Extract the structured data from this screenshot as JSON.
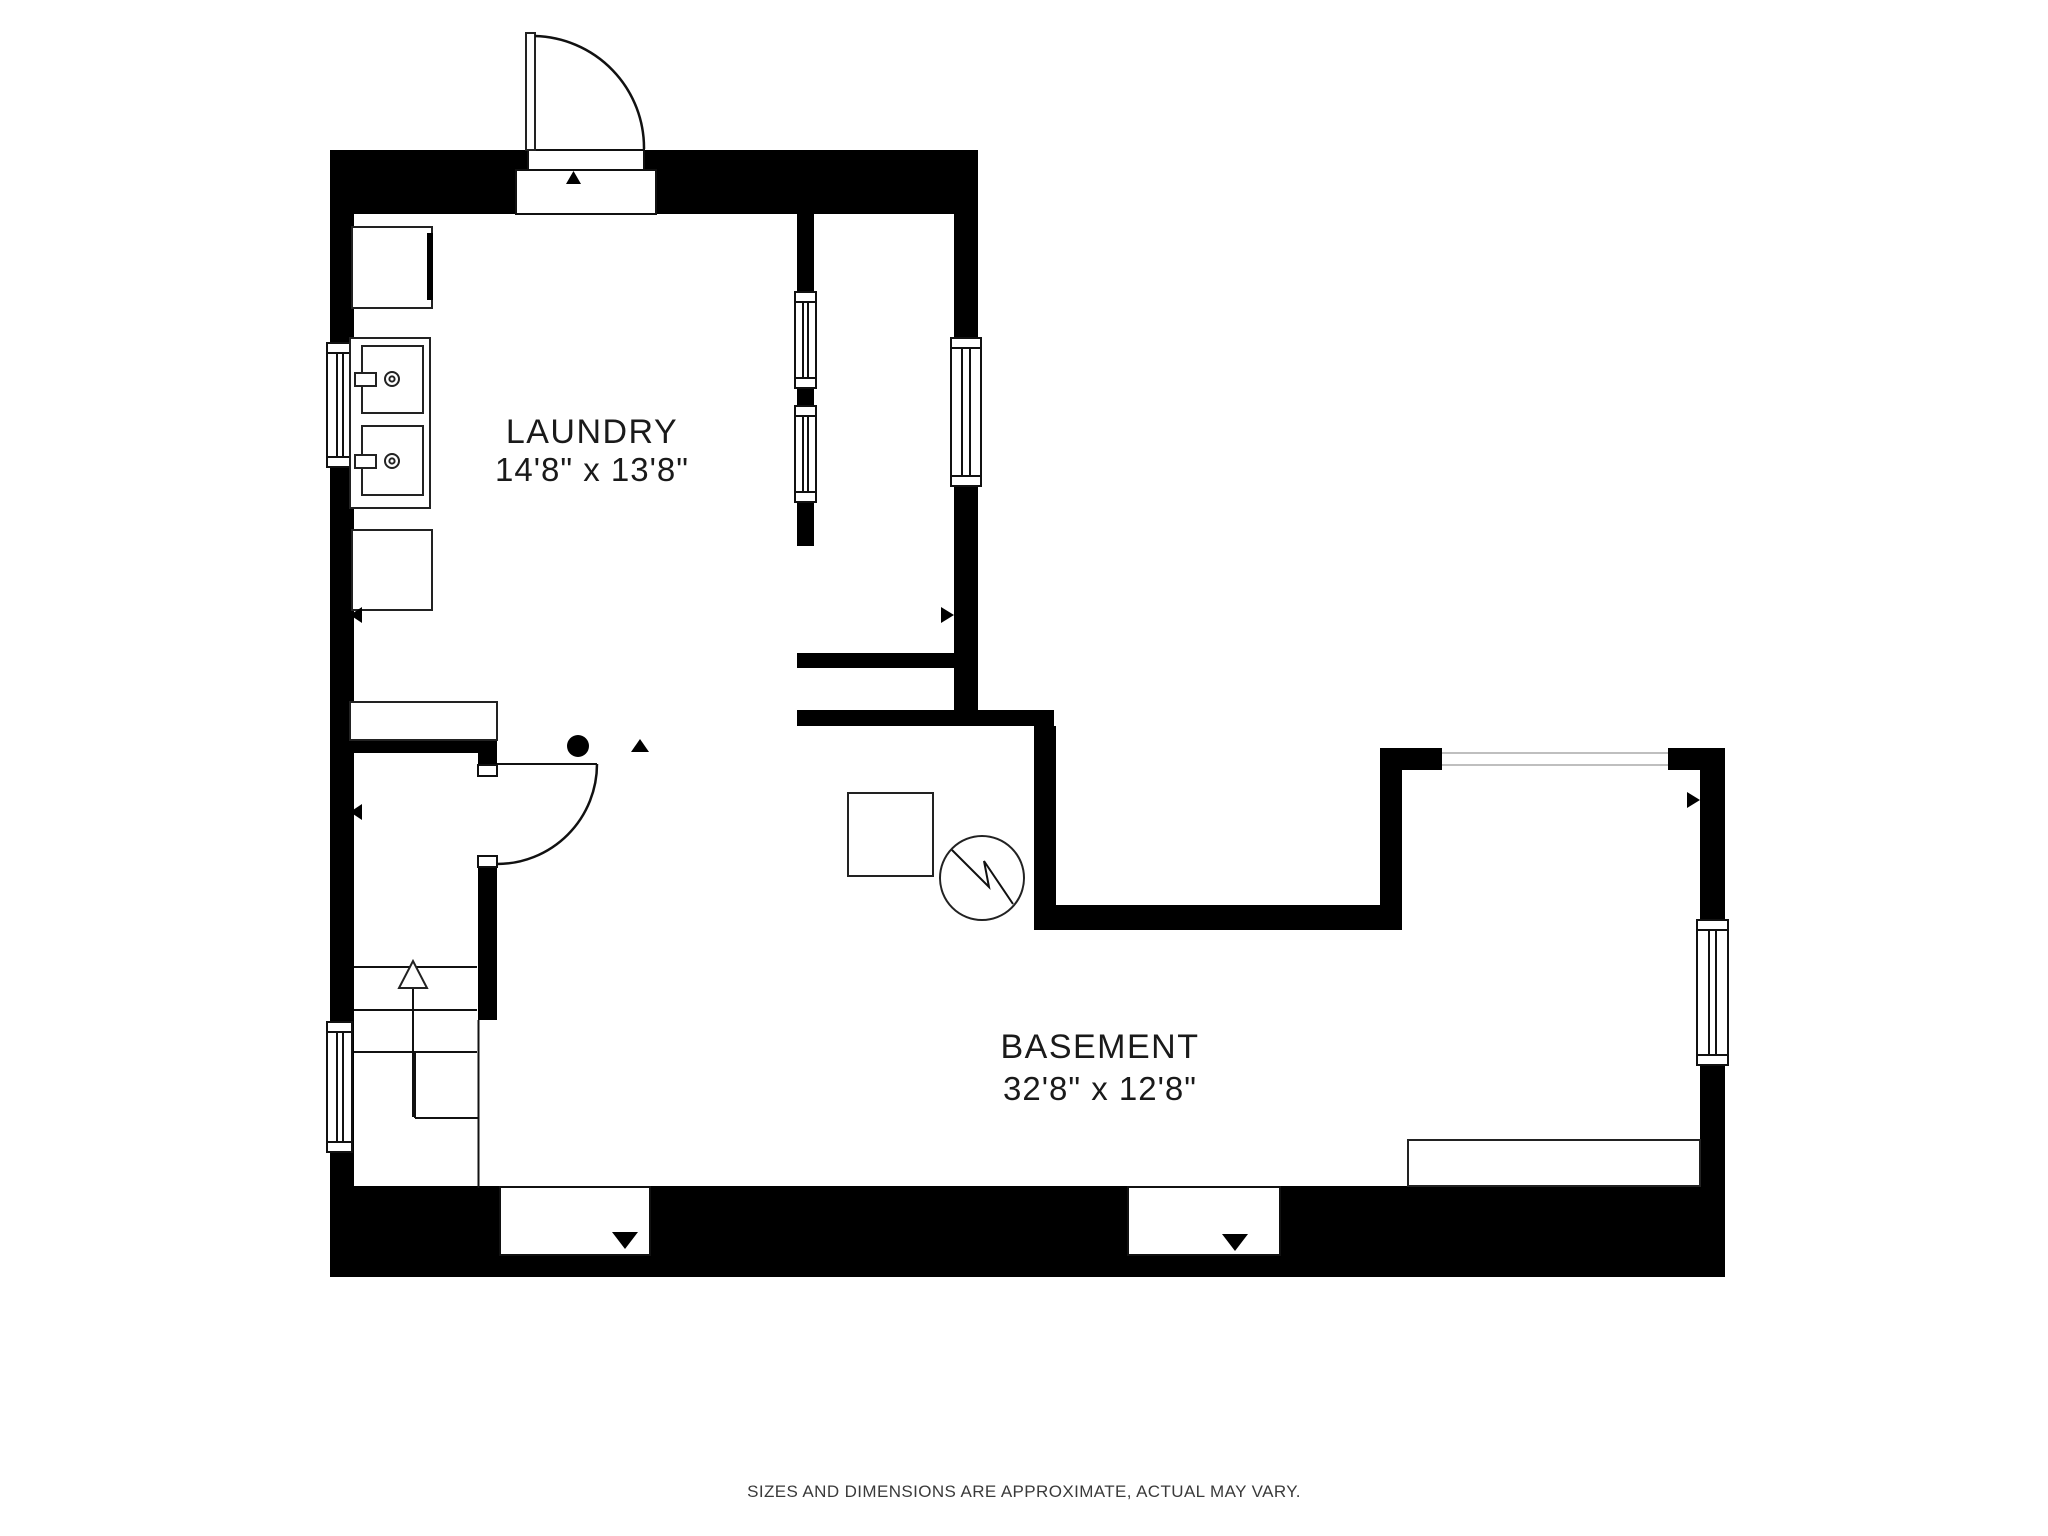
{
  "page": {
    "background_color": "#ffffff",
    "footer_disclaimer": "SIZES AND DIMENSIONS ARE APPROXIMATE, ACTUAL MAY VARY."
  },
  "floorplan": {
    "type": "basement-floor-plan",
    "wall_color": "#000000",
    "line_color": "#111111",
    "rooms": [
      {
        "id": "laundry",
        "label": "LAUNDRY",
        "dimensions": "14'8\" x 13'8\""
      },
      {
        "id": "basement",
        "label": "BASEMENT",
        "dimensions": "32'8\" x 12'8\""
      }
    ],
    "fixtures": [
      {
        "name": "washer-box-icon"
      },
      {
        "name": "double-laundry-sink-icon"
      },
      {
        "name": "dryer-box-icon"
      },
      {
        "name": "counter-icon"
      },
      {
        "name": "stairs-up-icon"
      },
      {
        "name": "water-heater-square-icon"
      },
      {
        "name": "furnace-circle-icon"
      },
      {
        "name": "shelf-icon"
      },
      {
        "name": "floor-drain-dot-icon"
      }
    ],
    "openings": [
      {
        "name": "entry-door-top"
      },
      {
        "name": "stair-closet-door"
      },
      {
        "name": "bottom-left-doorway"
      },
      {
        "name": "bottom-right-doorway"
      },
      {
        "name": "window-left-upper"
      },
      {
        "name": "window-left-lower"
      },
      {
        "name": "interior-glass-panel-1"
      },
      {
        "name": "interior-glass-panel-2"
      },
      {
        "name": "window-laundry-right"
      },
      {
        "name": "window-top-right"
      },
      {
        "name": "window-right-wall"
      }
    ]
  }
}
